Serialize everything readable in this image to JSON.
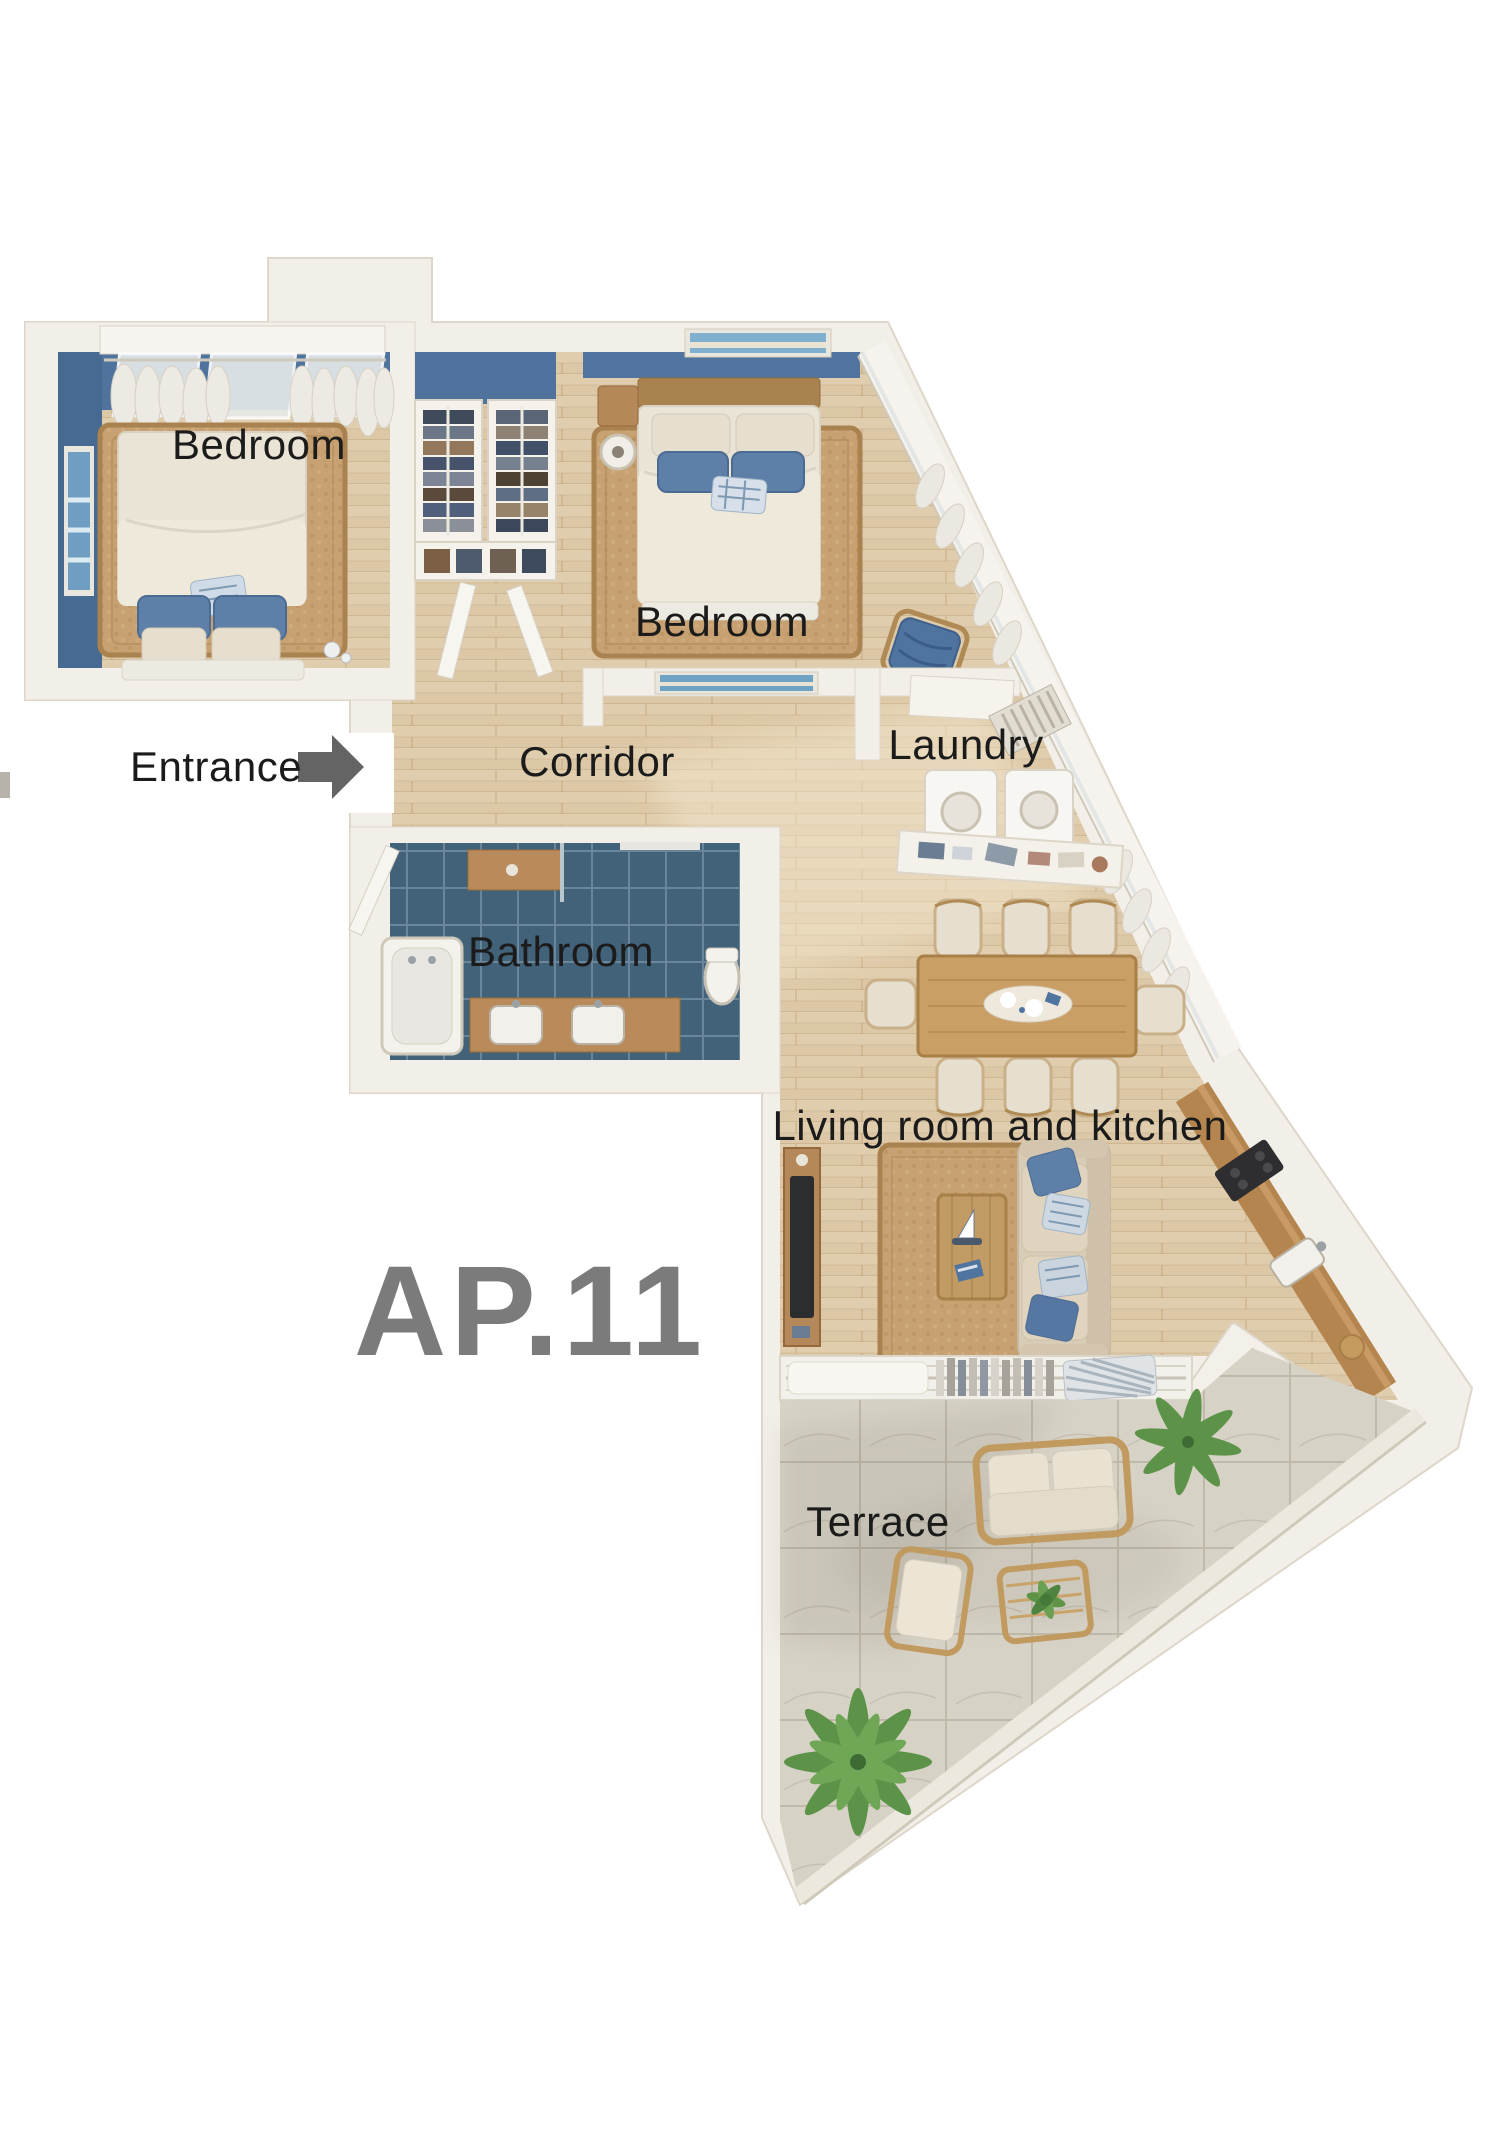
{
  "plan": {
    "apartment_id": "AP.11",
    "labels": {
      "bedroom_left": "Bedroom",
      "bedroom_right": "Bedroom",
      "entrance": "Entrance",
      "corridor": "Corridor",
      "laundry": "Laundry",
      "bathroom": "Bathroom",
      "living_kitchen": "Living room and kitchen",
      "terrace": "Terrace"
    },
    "colors": {
      "background": "#ffffff",
      "wall": "#f2efe8",
      "wall_edge": "#ddd6c9",
      "wood_floor": "#dcc7a6",
      "bathroom_tile": "#47687f",
      "terrace_tile": "#d7d2c6",
      "accent_blue_wall": "#4f739c",
      "pillow_blue": "#5e80a8",
      "rug_jute": "#c7a171",
      "counter_wood": "#b5854f",
      "label_text": "#1b1b1b",
      "apartment_id_text": "#7b7b7b",
      "entrance_arrow": "#646464",
      "plant_green": "#5d9348"
    }
  }
}
